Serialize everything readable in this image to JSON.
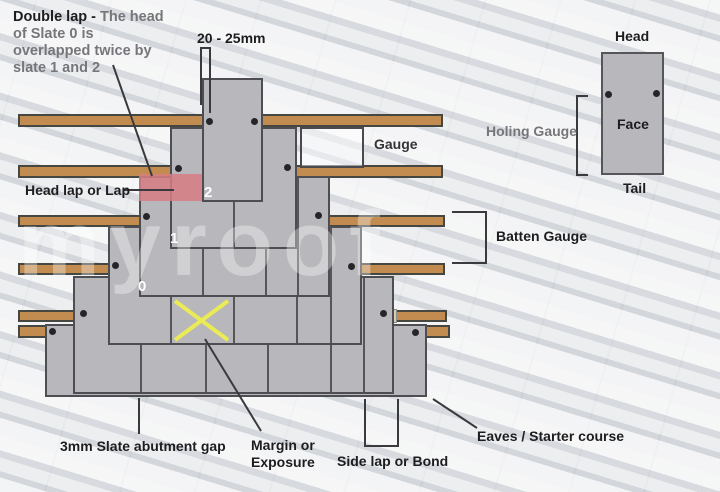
{
  "title": "Double lap slating diagram",
  "annotations": {
    "double_lap_bold": "Double lap - ",
    "double_lap_rest": "The head of Slate 0 is overlapped twice by slate 1 and 2",
    "nail_distance": "20 - 25mm",
    "gauge": "Gauge",
    "head_lap": "Head lap or Lap",
    "batten_gauge": "Batten Gauge",
    "holing_gauge": "Holing Gauge",
    "head": "Head",
    "face": "Face",
    "tail": "Tail",
    "abutment_gap": "3mm Slate abutment gap",
    "margin_line1": "Margin or",
    "margin_line2": "Exposure",
    "side_lap": "Side lap or Bond",
    "eaves": "Eaves / Starter course"
  },
  "slate_numbers": {
    "n0": "0",
    "n1": "1",
    "n2": "2"
  },
  "watermark": "myroof",
  "colors": {
    "slate": "#b8b8bc",
    "slate_border": "#4e4e52",
    "joint": "#56565a",
    "batten": "#c28c50",
    "cream_batten": "#d7cab6",
    "head_lap_highlight": "rgba(214,124,132,0.85)",
    "margin_x_yellow": "#ebeb55",
    "nail_hole": "#26262a",
    "annotation_line": "#3a3a3e"
  }
}
